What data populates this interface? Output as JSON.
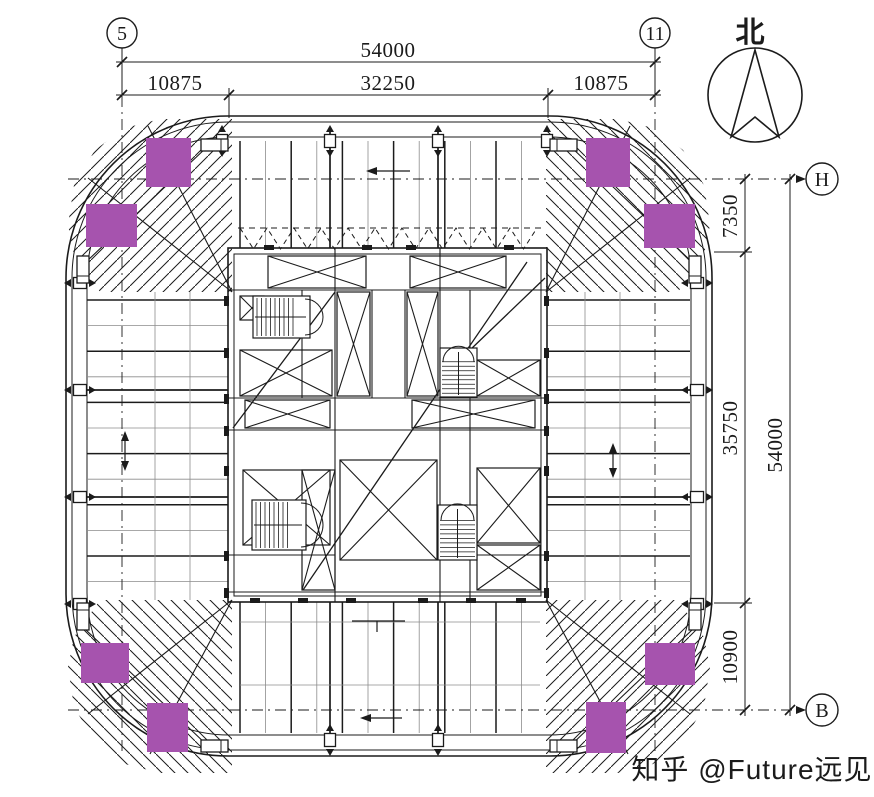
{
  "drawing": {
    "type": "structural-floor-plan",
    "north_label": "北",
    "watermark": "知乎 @Future远见"
  },
  "grid_bubbles": {
    "col_left": "5",
    "col_right": "11",
    "row_top": "H",
    "row_bottom": "B"
  },
  "dims_top": {
    "total": "54000",
    "segments": [
      "10875",
      "32250",
      "10875"
    ]
  },
  "dims_right": {
    "total": "54000",
    "segments": [
      "7350",
      "35750",
      "10900"
    ]
  },
  "colors": {
    "damper": "#a653ae",
    "ink": "#1b1b1b",
    "light_line": "#8c8c8c",
    "watermark": "#c9c9c9"
  }
}
